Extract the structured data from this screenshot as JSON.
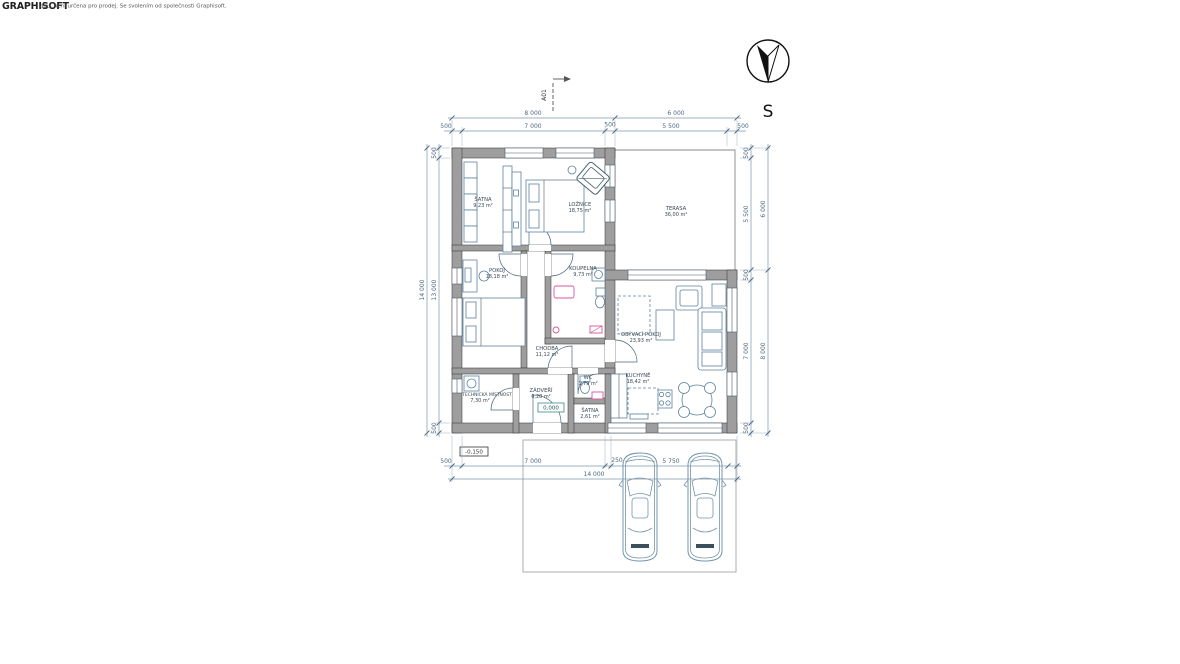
{
  "watermark": {
    "logo": "GRAPHISOFT",
    "text": "adu, není určena pro prodej. Se svolením od společnosti Graphisoft."
  },
  "compass": {
    "label": "S"
  },
  "section_markers": {
    "top": "A01",
    "bottom": "A01"
  },
  "levels": {
    "interior": "0,000",
    "exterior": "-0,150"
  },
  "rooms": [
    {
      "name": "ŠATNA",
      "area": "9,23 m²"
    },
    {
      "name": "LOŽNICE",
      "area": "18,75 m²"
    },
    {
      "name": "TERASA",
      "area": "36,00 m²"
    },
    {
      "name": "POKOJ",
      "area": "18,18 m²"
    },
    {
      "name": "KOUPELNA",
      "area": "9,73 m²"
    },
    {
      "name": "CHODBA",
      "area": "11,12 m²"
    },
    {
      "name": "TECHNICKÁ MÍSTNOST",
      "area": "7,30 m²"
    },
    {
      "name": "ZÁDVEŘÍ",
      "area": "6,28 m²"
    },
    {
      "name": "WC",
      "area": "1,79 m²"
    },
    {
      "name": "ŠATNA",
      "area": "2,61 m²"
    },
    {
      "name": "OBÝVACÍ POKOJ",
      "area": "23,93 m²"
    },
    {
      "name": "KUCHYNĚ",
      "area": "18,42 m²"
    }
  ],
  "dimensions": {
    "top_row1": [
      "8 000",
      "6 000"
    ],
    "top_row2": [
      "500",
      "7 000",
      "500",
      "5 500",
      "500"
    ],
    "left_outer": [
      "14 000"
    ],
    "left_inner": [
      "500",
      "13 000",
      "500"
    ],
    "right_inner": [
      "500",
      "5 500",
      "500",
      "7 000",
      "500"
    ],
    "right_outer": [
      "6 000",
      "8 000"
    ],
    "bottom_row1": [
      "500",
      "7 000",
      "250",
      "5 750"
    ],
    "bottom_row2": [
      "14 000"
    ]
  },
  "colors": {
    "wall_fill": "#9e9e9e",
    "furniture_line": "#5c83a0",
    "fixture_pink": "#d8569b",
    "dimension_line": "#7a97ad",
    "dimension_text": "#4d6880",
    "car_line": "#7595ac",
    "level_box_border": "#3a8a8a"
  }
}
